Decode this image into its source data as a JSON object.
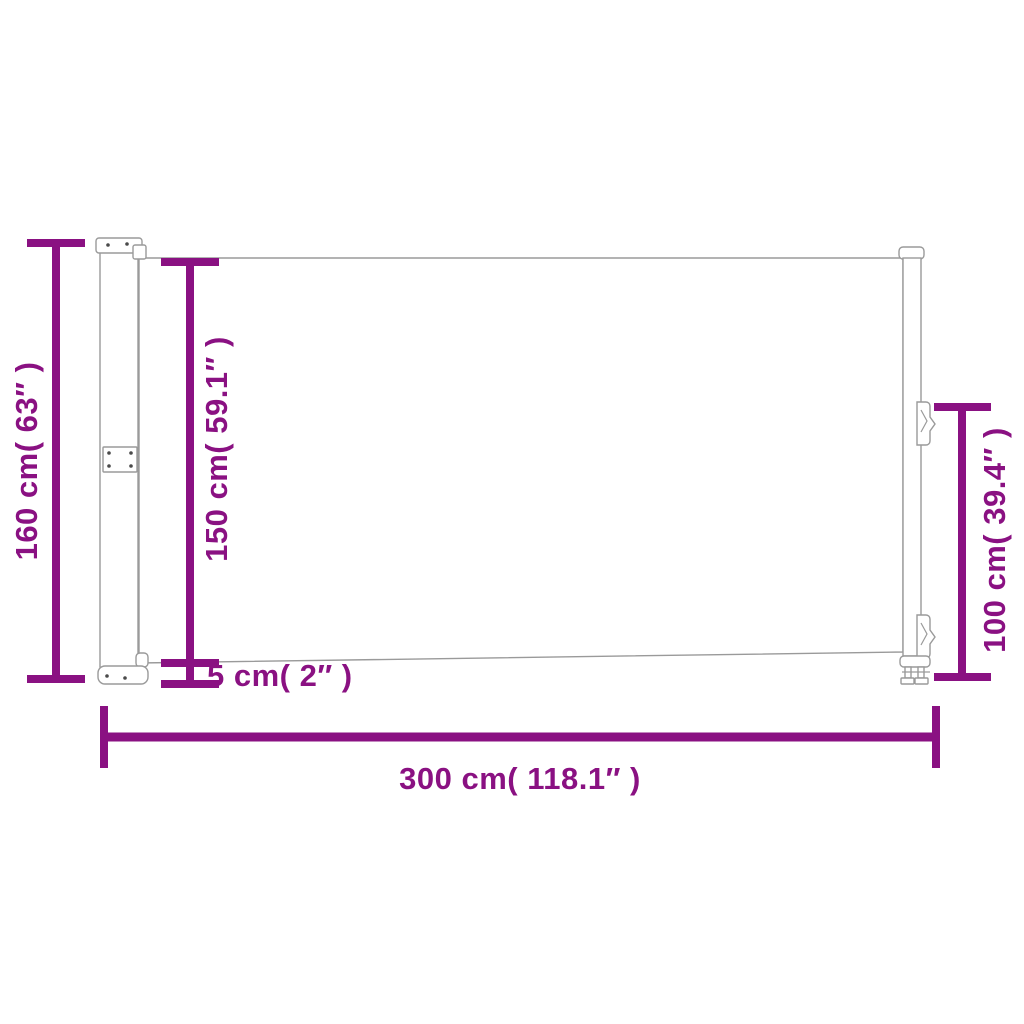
{
  "colors": {
    "accent": "#8A1182",
    "outline": "#9A9A9A",
    "background": "#FFFFFF"
  },
  "dimensions": {
    "total_height": {
      "label": "160 cm( 63″ )",
      "cm": 160,
      "inches": 63
    },
    "fabric_height": {
      "label": "150 cm( 59.1″ )",
      "cm": 150,
      "inches": 59.1
    },
    "bottom_gap": {
      "label": "5 cm( 2″ )",
      "cm": 5,
      "inches": 2
    },
    "pole_height": {
      "label": "100 cm( 39.4″ )",
      "cm": 100,
      "inches": 39.4
    },
    "total_width": {
      "label": "300 cm( 118.1″ )",
      "cm": 300,
      "inches": 118.1
    }
  }
}
